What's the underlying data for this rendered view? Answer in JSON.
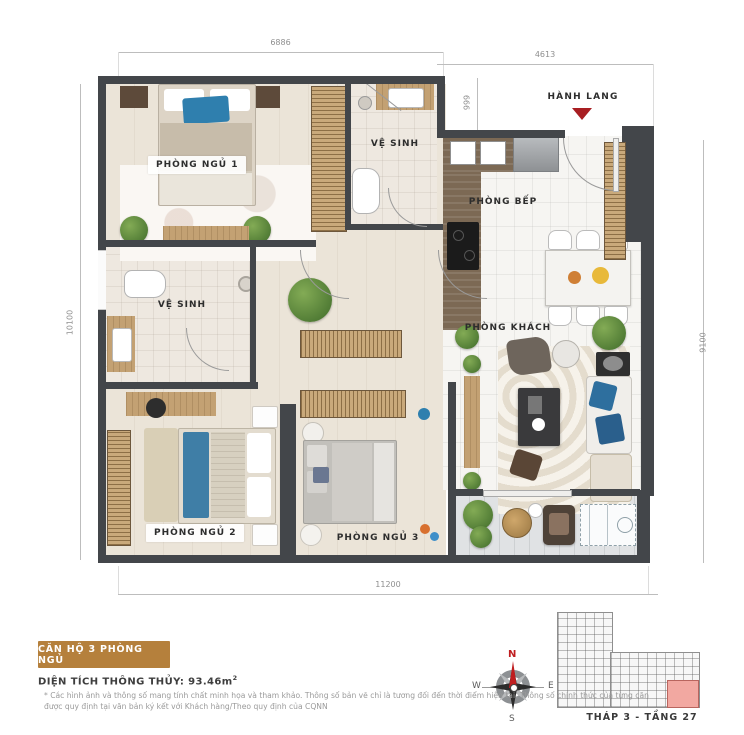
{
  "plan": {
    "rooms": {
      "bedroom1": "PHÒNG NGỦ 1",
      "bathroom1": "VỆ SINH",
      "bathroom2": "VỆ SINH",
      "kitchen": "PHÒNG BẾP",
      "living": "PHÒNG KHÁCH",
      "bedroom2": "PHÒNG NGỦ 2",
      "bedroom3": "PHÒNG NGỦ 3",
      "hallway": "HÀNH LANG"
    },
    "dimensions": {
      "top_left": "6886",
      "top_right": "4613",
      "entry_depth": "999",
      "left": "10100",
      "right": "9100",
      "bottom": "11200"
    }
  },
  "info": {
    "unit_badge": "CĂN HỘ 3 PHÒNG NGỦ",
    "area_label": "DIỆN TÍCH THÔNG THỦY: 93.46m",
    "area_superscript": "2",
    "disclaimer": "* Các hình ảnh và thông số mang tính chất minh họa và tham khảo. Thông số bản vẽ chỉ là tương đối đến thời điểm hiện tại. Thông số chính thức của từng căn được quy định tại văn bản ký kết với Khách hàng/Theo quy định của CQNN"
  },
  "compass": {
    "north": "N",
    "south": "S",
    "east": "E",
    "west": "W"
  },
  "mini_plan": {
    "caption": "THÁP 3 - TẦNG 27"
  },
  "colors": {
    "accent_gold": "#b5803c",
    "wall_dark": "#43464a",
    "entry_red": "#a81e22",
    "unit_highlight": "#f2a8a1"
  }
}
